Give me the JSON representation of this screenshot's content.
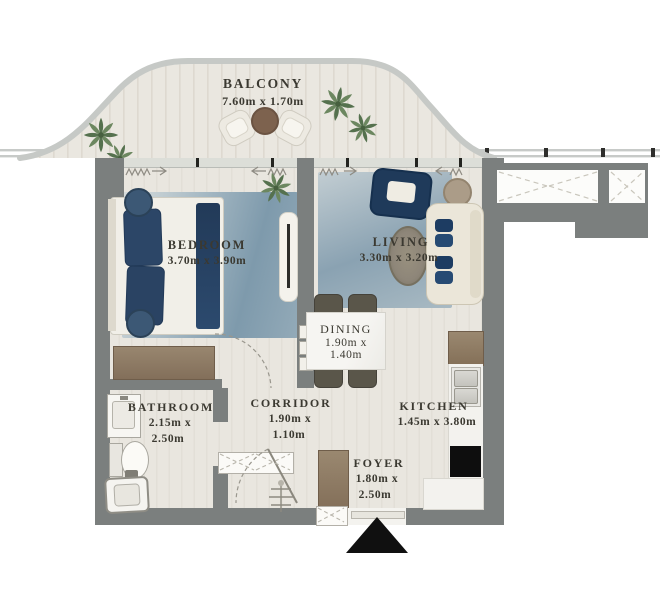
{
  "rooms": {
    "balcony": {
      "name": "BALCONY",
      "dims": [
        "7.60m x 1.70m"
      ]
    },
    "bedroom": {
      "name": "BEDROOM",
      "dims": [
        "3.70m x 3.90m"
      ]
    },
    "living": {
      "name": "LIVING",
      "dims": [
        "3.30m x 3.20m"
      ]
    },
    "dining": {
      "name": "DINING",
      "dims": [
        "1.90m x",
        "1.40m"
      ]
    },
    "corridor": {
      "name": "CORRIDOR",
      "dims": [
        "1.90m x",
        "1.10m"
      ]
    },
    "bathroom": {
      "name": "BATHROOM",
      "dims": [
        "2.15m x",
        "2.50m"
      ]
    },
    "kitchen": {
      "name": "KITCHEN",
      "dims": [
        "1.45m x 3.80m"
      ]
    },
    "foyer": {
      "name": "FOYER",
      "dims": [
        "1.80m x",
        "2.50m"
      ]
    }
  },
  "colors": {
    "wall": "#7b7f7e",
    "floor": "#e8e5de",
    "rug_blue": "#8ea7b6",
    "navy": "#2b4565",
    "wood": "#8f7d69",
    "marble": "#f3f2ee",
    "label_text": "#3b3931",
    "entrance_marker": "#101010",
    "plant_green": "#5d7a54"
  },
  "icons": {
    "entrance_marker": "up-triangle",
    "shaft_symbol": "dashed-x-box",
    "curtain_symbol": "zigzag-arrow"
  }
}
